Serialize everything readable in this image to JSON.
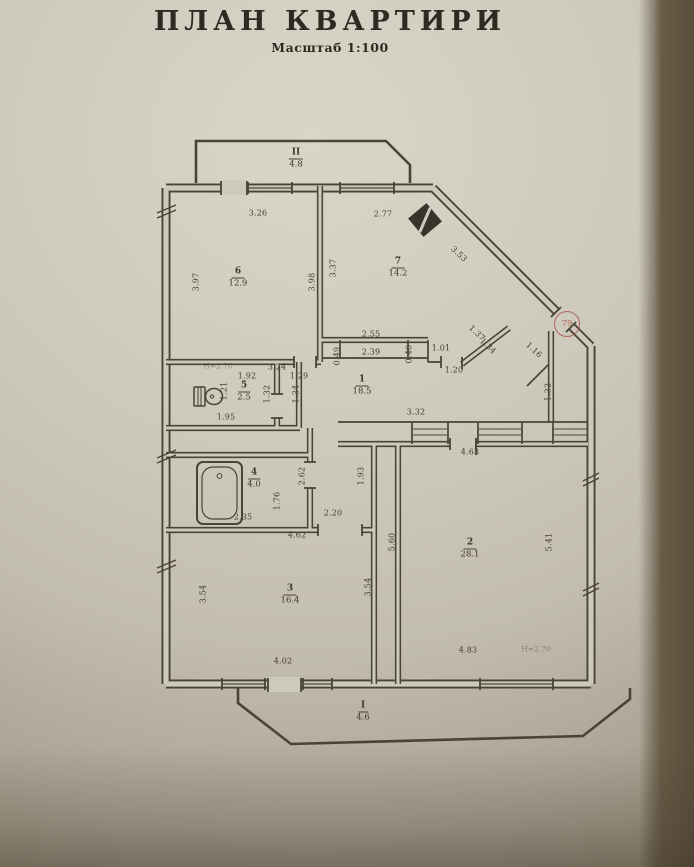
{
  "page": {
    "title": "ПЛАН  КВАРТИРИ",
    "subtitle": "Масштаб 1:100"
  },
  "plan": {
    "rooms": [
      {
        "num": "II",
        "area": "4.8",
        "x": 296,
        "y": 159
      },
      {
        "num": "6",
        "area": "12.9",
        "x": 238,
        "y": 278
      },
      {
        "num": "7",
        "area": "14.2",
        "x": 398,
        "y": 268
      },
      {
        "num": "5",
        "area": "2.5",
        "x": 244,
        "y": 392
      },
      {
        "num": "1",
        "area": "18.5",
        "x": 362,
        "y": 386
      },
      {
        "num": "4",
        "area": "4.0",
        "x": 254,
        "y": 479
      },
      {
        "num": "3",
        "area": "16.4",
        "x": 290,
        "y": 595
      },
      {
        "num": "2",
        "area": "28.1",
        "x": 470,
        "y": 549
      },
      {
        "num": "I",
        "area": "4.6",
        "x": 363,
        "y": 712
      }
    ],
    "dimensions": [
      {
        "t": "3.26",
        "x": 258,
        "y": 213,
        "r": 0
      },
      {
        "t": "2.77",
        "x": 383,
        "y": 214,
        "r": 0
      },
      {
        "t": "3.97",
        "x": 196,
        "y": 282,
        "r": -90
      },
      {
        "t": "3.98",
        "x": 312,
        "y": 282,
        "r": -90
      },
      {
        "t": "3.37",
        "x": 333,
        "y": 268,
        "r": -90
      },
      {
        "t": "3.53",
        "x": 459,
        "y": 254,
        "r": 43
      },
      {
        "t": "3.24",
        "x": 277,
        "y": 367,
        "r": 0
      },
      {
        "t": "1.92",
        "x": 247,
        "y": 376,
        "r": 0
      },
      {
        "t": "1.29",
        "x": 299,
        "y": 376,
        "r": 0
      },
      {
        "t": "1.21",
        "x": 224,
        "y": 391,
        "r": -90
      },
      {
        "t": "1.32",
        "x": 267,
        "y": 394,
        "r": -90
      },
      {
        "t": "1.34",
        "x": 296,
        "y": 394,
        "r": -90
      },
      {
        "t": "1.95",
        "x": 226,
        "y": 417,
        "r": 0
      },
      {
        "t": "2.55",
        "x": 371,
        "y": 334,
        "r": 0
      },
      {
        "t": "2.39",
        "x": 371,
        "y": 352,
        "r": 0
      },
      {
        "t": "0.49",
        "x": 337,
        "y": 356,
        "r": -90
      },
      {
        "t": "0.40",
        "x": 409,
        "y": 354,
        "r": -90
      },
      {
        "t": "1.01",
        "x": 441,
        "y": 348,
        "r": 0
      },
      {
        "t": "1.20",
        "x": 454,
        "y": 370,
        "r": 0
      },
      {
        "t": "1.37",
        "x": 477,
        "y": 333,
        "r": 43
      },
      {
        "t": "1.34",
        "x": 488,
        "y": 346,
        "r": 43
      },
      {
        "t": "1.16",
        "x": 534,
        "y": 350,
        "r": 43
      },
      {
        "t": "1.32",
        "x": 548,
        "y": 392,
        "r": -90
      },
      {
        "t": "3.32",
        "x": 416,
        "y": 412,
        "r": 0
      },
      {
        "t": "4.63",
        "x": 470,
        "y": 452,
        "r": 0
      },
      {
        "t": "2.62",
        "x": 302,
        "y": 476,
        "r": -90
      },
      {
        "t": "1.93",
        "x": 361,
        "y": 476,
        "r": -90
      },
      {
        "t": "1.76",
        "x": 277,
        "y": 501,
        "r": -90
      },
      {
        "t": "2.35",
        "x": 243,
        "y": 517,
        "r": 0
      },
      {
        "t": "2.20",
        "x": 333,
        "y": 513,
        "r": 0
      },
      {
        "t": "4.62",
        "x": 297,
        "y": 535,
        "r": 0
      },
      {
        "t": "5.60",
        "x": 392,
        "y": 542,
        "r": -90
      },
      {
        "t": "5.41",
        "x": 549,
        "y": 542,
        "r": -90
      },
      {
        "t": "3.54",
        "x": 203,
        "y": 594,
        "r": -90
      },
      {
        "t": "3.54",
        "x": 368,
        "y": 587,
        "r": -90
      },
      {
        "t": "4.02",
        "x": 283,
        "y": 661,
        "r": 0
      },
      {
        "t": "4.83",
        "x": 468,
        "y": 650,
        "r": 0
      }
    ],
    "notes": [
      {
        "t": "Н=2.70",
        "x": 218,
        "y": 366
      },
      {
        "t": "Н=2.70",
        "x": 536,
        "y": 649
      }
    ],
    "entrance_stamp": {
      "number": "79",
      "color": "#a34a38"
    },
    "colors": {
      "paper": "#cdc9bc",
      "ink": "#4a4337",
      "backdrop": "#6a5b46",
      "stamp": "#a34a38"
    }
  }
}
